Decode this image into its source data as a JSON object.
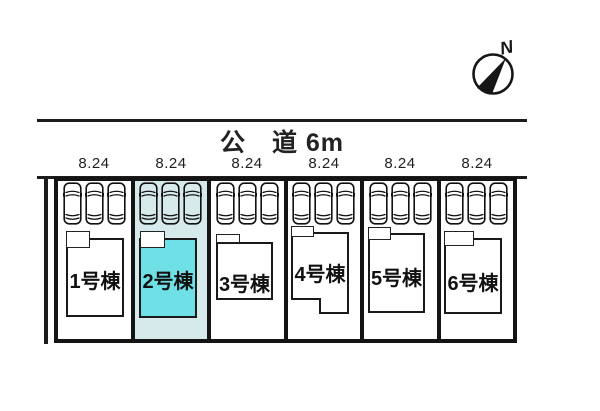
{
  "plan": {
    "road_label": "公　道 6m",
    "compass_label": "N"
  },
  "lots": [
    {
      "dimension": "8.24",
      "label": "1号棟",
      "highlighted": false
    },
    {
      "dimension": "8.24",
      "label": "2号棟",
      "highlighted": true
    },
    {
      "dimension": "8.24",
      "label": "3号棟",
      "highlighted": false
    },
    {
      "dimension": "8.24",
      "label": "4号棟",
      "highlighted": false
    },
    {
      "dimension": "8.24",
      "label": "5号棟",
      "highlighted": false
    },
    {
      "dimension": "8.24",
      "label": "6号棟",
      "highlighted": false
    }
  ],
  "parking": {
    "spaces_per_lot": 3
  },
  "colors": {
    "line": "#1c1c1c",
    "highlight_lot_bg": "#d6eaeb",
    "highlight_building_bg": "#6fe0e6"
  }
}
